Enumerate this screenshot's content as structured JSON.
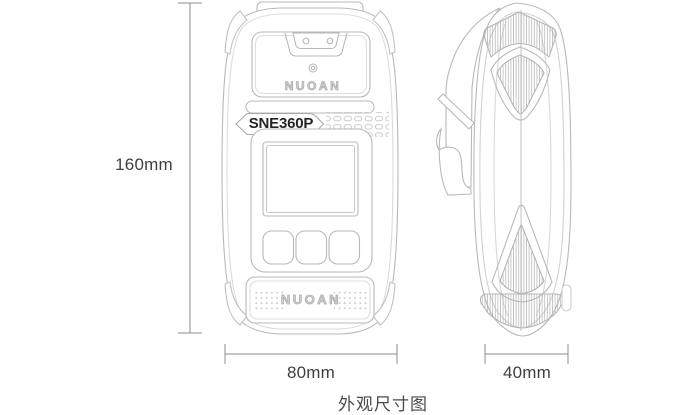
{
  "caption": "外观尺寸图",
  "device": {
    "brand": "NUOAN",
    "model": "SNE360P"
  },
  "dimensions": {
    "height": "160mm",
    "width": "80mm",
    "depth": "40mm"
  },
  "colors": {
    "background": "#ffffff",
    "outline": "#b9b9b9",
    "outline_light": "#d9d9d9",
    "hatch": "#b0b0b0",
    "dimension_line": "#8e8e8e",
    "label_text": "#3f3f3f"
  }
}
